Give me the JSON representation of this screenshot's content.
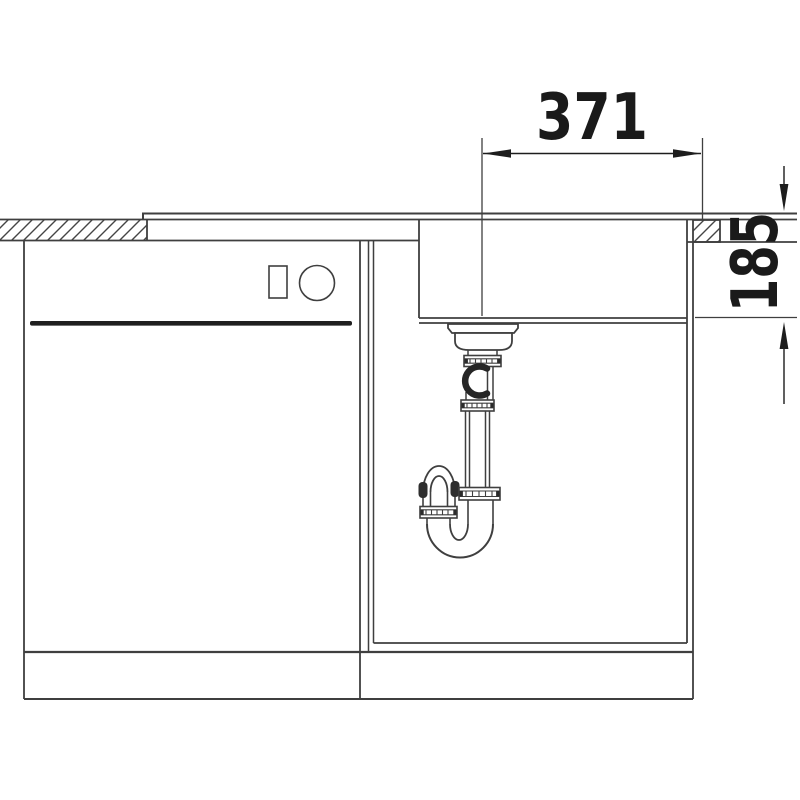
{
  "diagram": {
    "type": "technical-drawing",
    "subject": "kitchen sink installation cross-section with drain siphon",
    "dimensions": {
      "width_label": "371",
      "depth_label": "185"
    },
    "colors": {
      "background": "#ffffff",
      "line": "#3f3f3f",
      "dark": "#1d1d1d",
      "label_text": "#1a1a1a"
    }
  }
}
